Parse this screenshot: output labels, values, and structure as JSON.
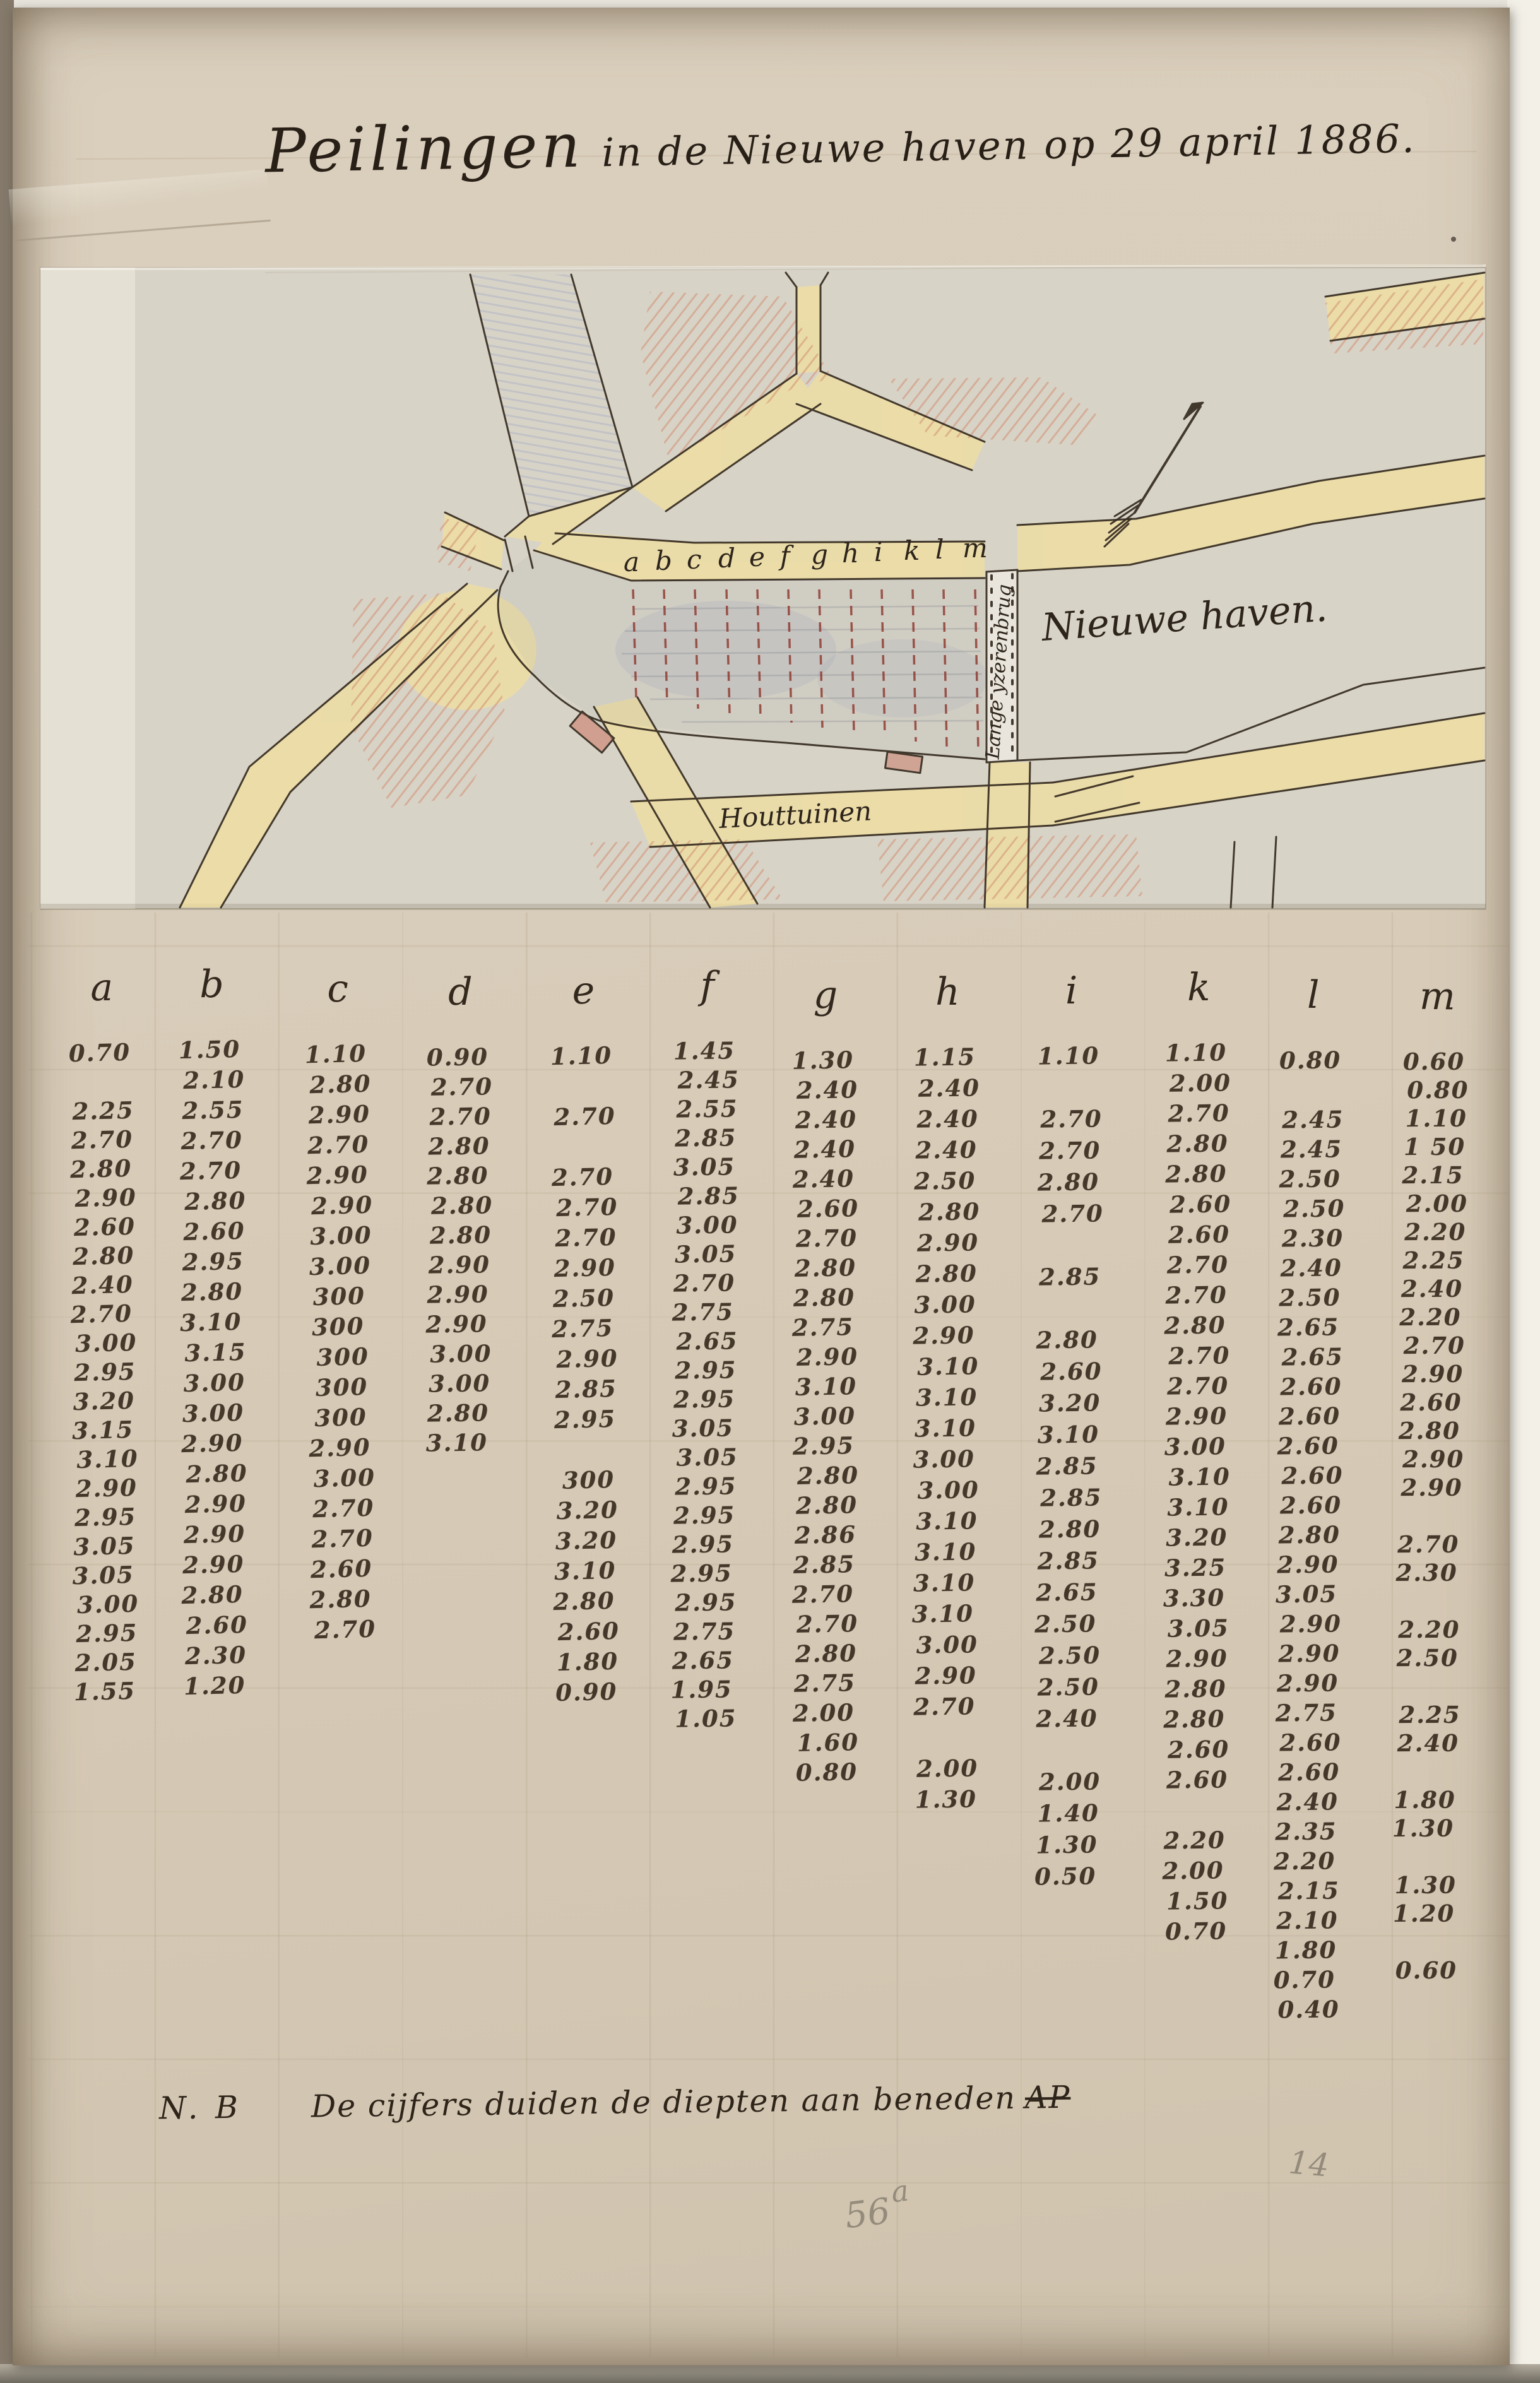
{
  "header": {
    "title_main": "Peilingen",
    "title_rest": "in de Nieuwe haven op 29 april 1886."
  },
  "map": {
    "transect_letters": [
      "a",
      "b",
      "c",
      "d",
      "e",
      "f",
      "g",
      "h",
      "i",
      "k",
      "l",
      "m"
    ],
    "labels": {
      "harbor": "Nieuwe haven.",
      "bridge": "Lange yzerenbrug",
      "street": "Houttuinen"
    }
  },
  "table": {
    "columns": [
      {
        "label": "a",
        "values": [
          "0.70",
          "",
          "2.25",
          "2.70",
          "2.80",
          "2.90",
          "2.60",
          "2.80",
          "2.40",
          "2.70",
          "3.00",
          "2.95",
          "3.20",
          "3.15",
          "3.10",
          "2.90",
          "2.95",
          "3.05",
          "3.05",
          "3.00",
          "2.95",
          "2.05",
          "1.55"
        ]
      },
      {
        "label": "b",
        "values": [
          "1.50",
          "2.10",
          "2.55",
          "2.70",
          "2.70",
          "2.80",
          "2.60",
          "2.95",
          "2.80",
          "3.10",
          "3.15",
          "3.00",
          "3.00",
          "2.90",
          "2.80",
          "2.90",
          "2.90",
          "2.90",
          "2.80",
          "2.60",
          "2.30",
          "1.20"
        ]
      },
      {
        "label": "c",
        "values": [
          "1.10",
          "2.80",
          "2.90",
          "2.70",
          "2.90",
          "2.90",
          "3.00",
          "3.00",
          "300",
          "300",
          "300",
          "300",
          "300",
          "2.90",
          "3.00",
          "2.70",
          "2.70",
          "2.60",
          "2.80",
          "2.70"
        ]
      },
      {
        "label": "d",
        "values": [
          "0.90",
          "2.70",
          "2.70",
          "2.80",
          "2.80",
          "2.80",
          "2.80",
          "2.90",
          "2.90",
          "2.90",
          "3.00",
          "3.00",
          "2.80",
          "3.10"
        ]
      },
      {
        "label": "e",
        "values": [
          "1.10",
          "",
          "2.70",
          "",
          "2.70",
          "2.70",
          "2.70",
          "2.90",
          "2.50",
          "2.75",
          "2.90",
          "2.85",
          "2.95",
          "",
          "300",
          "3.20",
          "3.20",
          "3.10",
          "2.80",
          "2.60",
          "1.80",
          "0.90"
        ]
      },
      {
        "label": "f",
        "values": [
          "1.45",
          "2.45",
          "2.55",
          "2.85",
          "3.05",
          "2.85",
          "3.00",
          "3.05",
          "2.70",
          "2.75",
          "2.65",
          "2.95",
          "2.95",
          "3.05",
          "3.05",
          "2.95",
          "2.95",
          "2.95",
          "2.95",
          "2.95",
          "2.75",
          "2.65",
          "1.95",
          "1.05"
        ]
      },
      {
        "label": "g",
        "values": [
          "1.30",
          "2.40",
          "2.40",
          "2.40",
          "2.40",
          "2.60",
          "2.70",
          "2.80",
          "2.80",
          "2.75",
          "2.90",
          "3.10",
          "3.00",
          "2.95",
          "2.80",
          "2.80",
          "2.86",
          "2.85",
          "2.70",
          "2.70",
          "2.80",
          "2.75",
          "2.00",
          "1.60",
          "0.80"
        ]
      },
      {
        "label": "h",
        "values": [
          "1.15",
          "2.40",
          "2.40",
          "2.40",
          "2.50",
          "2.80",
          "2.90",
          "2.80",
          "3.00",
          "2.90",
          "3.10",
          "3.10",
          "3.10",
          "3.00",
          "3.00",
          "3.10",
          "3.10",
          "3.10",
          "3.10",
          "3.00",
          "2.90",
          "2.70",
          "",
          "2.00",
          "1.30"
        ]
      },
      {
        "label": "i",
        "values": [
          "1.10",
          "",
          "2.70",
          "2.70",
          "2.80",
          "2.70",
          "",
          "2.85",
          "",
          "2.80",
          "2.60",
          "3.20",
          "3.10",
          "2.85",
          "2.85",
          "2.80",
          "2.85",
          "2.65",
          "2.50",
          "2.50",
          "2.50",
          "2.40",
          "",
          "2.00",
          "1.40",
          "1.30",
          "0.50"
        ]
      },
      {
        "label": "k",
        "values": [
          "1.10",
          "2.00",
          "2.70",
          "2.80",
          "2.80",
          "2.60",
          "2.60",
          "2.70",
          "2.70",
          "2.80",
          "2.70",
          "2.70",
          "2.90",
          "3.00",
          "3.10",
          "3.10",
          "3.20",
          "3.25",
          "3.30",
          "3.05",
          "2.90",
          "2.80",
          "2.80",
          "2.60",
          "2.60",
          "",
          "2.20",
          "2.00",
          "1.50",
          "0.70"
        ]
      },
      {
        "label": "l",
        "values": [
          "0.80",
          "",
          "2.45",
          "2.45",
          "2.50",
          "2.50",
          "2.30",
          "2.40",
          "2.50",
          "2.65",
          "2.65",
          "2.60",
          "2.60",
          "2.60",
          "2.60",
          "2.60",
          "2.80",
          "2.90",
          "3.05",
          "2.90",
          "2.90",
          "2.90",
          "2.75",
          "2.60",
          "2.60",
          "2.40",
          "2.35",
          "2.20",
          "2.15",
          "2.10",
          "1.80",
          "0.70",
          "0.40"
        ]
      },
      {
        "label": "m",
        "values": [
          "0.60",
          "0.80",
          "1.10",
          "1 50",
          "2.15",
          "2.00",
          "2.20",
          "2.25",
          "2.40",
          "2.20",
          "2.70",
          "2.90",
          "2.60",
          "2.80",
          "2.90",
          "2.90",
          "",
          "2.70",
          "2.30",
          "",
          "2.20",
          "2.50",
          "",
          "2.25",
          "2.40",
          "",
          "1.80",
          "1.30",
          "",
          "1.30",
          "1.20",
          "",
          "0.60"
        ]
      }
    ]
  },
  "note": {
    "prefix": "N. B",
    "text": "De cijfers duiden de diepten aan beneden",
    "datum": "AP"
  },
  "annotations": {
    "inventory": "56",
    "inventory_sup": "a",
    "page": "14"
  },
  "colors": {
    "ink": "#3a2d20",
    "red-dash": "#8d352b",
    "street-yellow": "#f1df9e",
    "hatch-red": "#d08a6a",
    "shade-blue": "#97a3c6",
    "pencil": "#948b7b"
  }
}
